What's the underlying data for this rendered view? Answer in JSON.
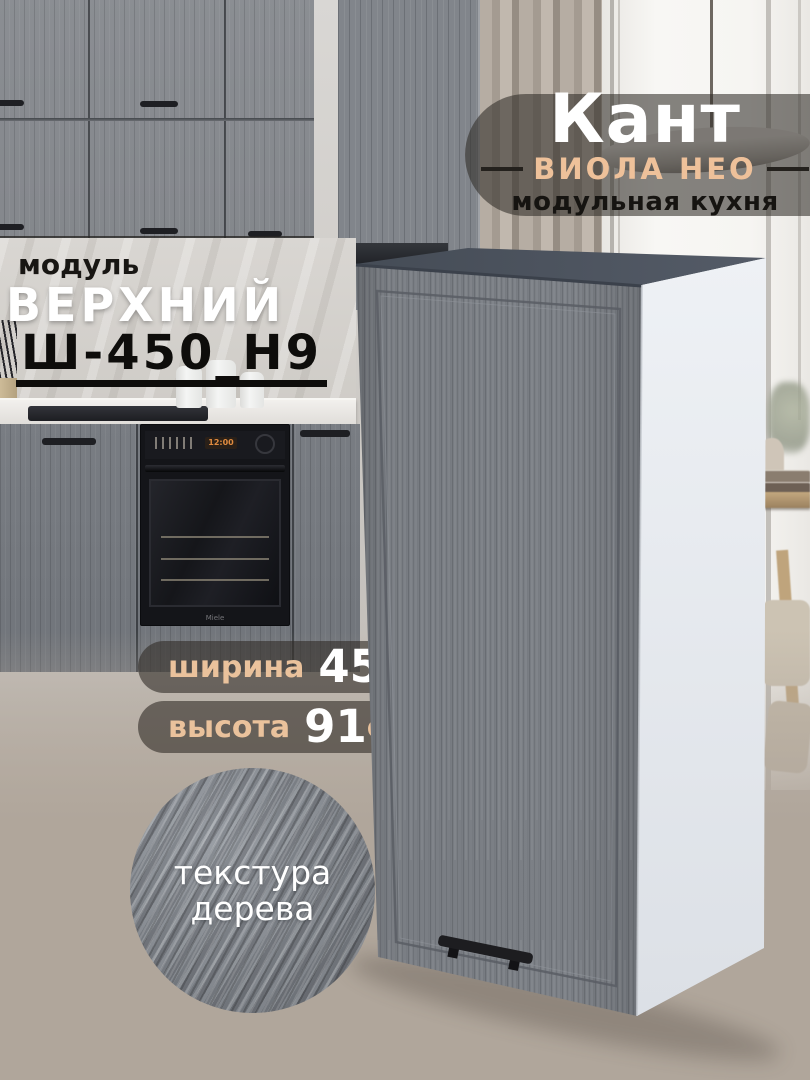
{
  "brand": {
    "title": "Кант",
    "series": "ВИОЛА НЕО",
    "tagline": "модульная кухня"
  },
  "module": {
    "eyebrow": "модуль",
    "name": "ВЕРХНИЙ",
    "code": "Ш-450_Н9"
  },
  "specs": [
    {
      "label": "ширина",
      "value": "45",
      "unit": "см"
    },
    {
      "label": "высота",
      "value": "91",
      "unit": "см"
    }
  ],
  "texture_badge": {
    "line1": "текстура",
    "line2": "дерева"
  },
  "appliance": {
    "brand": "Miele",
    "display": "12:00"
  },
  "colors": {
    "accent_peach": "#eac29c",
    "pill_background": "rgba(49,44,39,0.6)",
    "backdrop_taupe": "#b0a69b",
    "door_gray": "#7c8086",
    "cabinet_top_slate": "#4c535e",
    "cabinet_side_white": "#e9edf2"
  }
}
